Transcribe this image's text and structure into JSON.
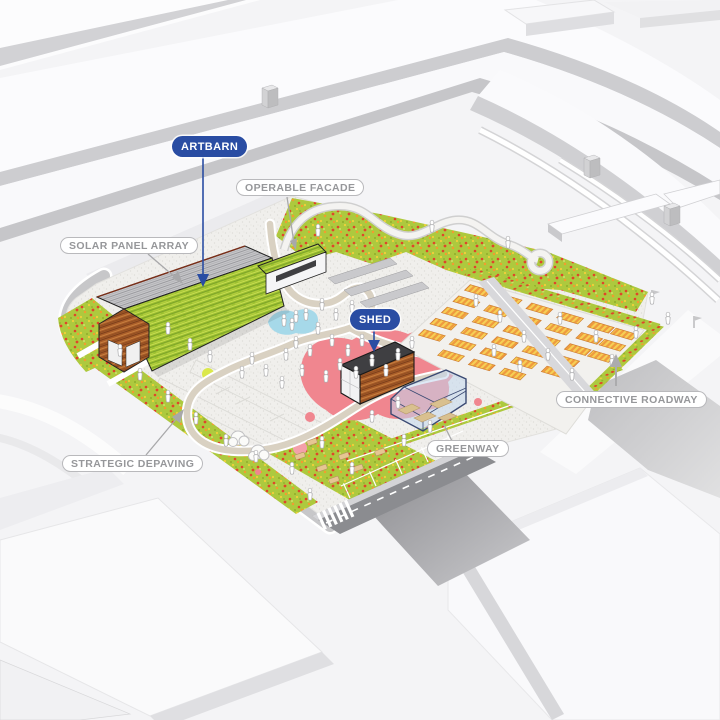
{
  "diagram": {
    "labels": {
      "artbarn": "ARTBARN",
      "operable_facade": "OPERABLE FACADE",
      "solar_panel_array": "SOLAR PANEL ARRAY",
      "shed": "SHED",
      "connective_roadway": "CONNECTIVE ROADWAY",
      "greenway": "GREENWAY",
      "strategic_depaving": "STRATEGIC DEPAVING"
    },
    "legend_icon_names": [
      "down-arrow-icon",
      "up-arrow-icon",
      "leader-line"
    ],
    "colors": {
      "accent_blue": "#2a4da3",
      "label_gray": "#96979a",
      "meadow_green": "#adc93e",
      "flower_red": "#e0452a",
      "roof_green": "#9cc12f",
      "wood_brown": "#a85c28",
      "solar_gray": "#c7c7ca",
      "plaza_pink": "#f0868f",
      "water_blue": "#a6d9e9",
      "bed_orange": "#ef9b3f",
      "bed_yellow": "#f6cf55",
      "glass_blue": "#c3d7ee",
      "road_gray": "#8b8c90",
      "path_tan": "#d9d1c2"
    }
  }
}
